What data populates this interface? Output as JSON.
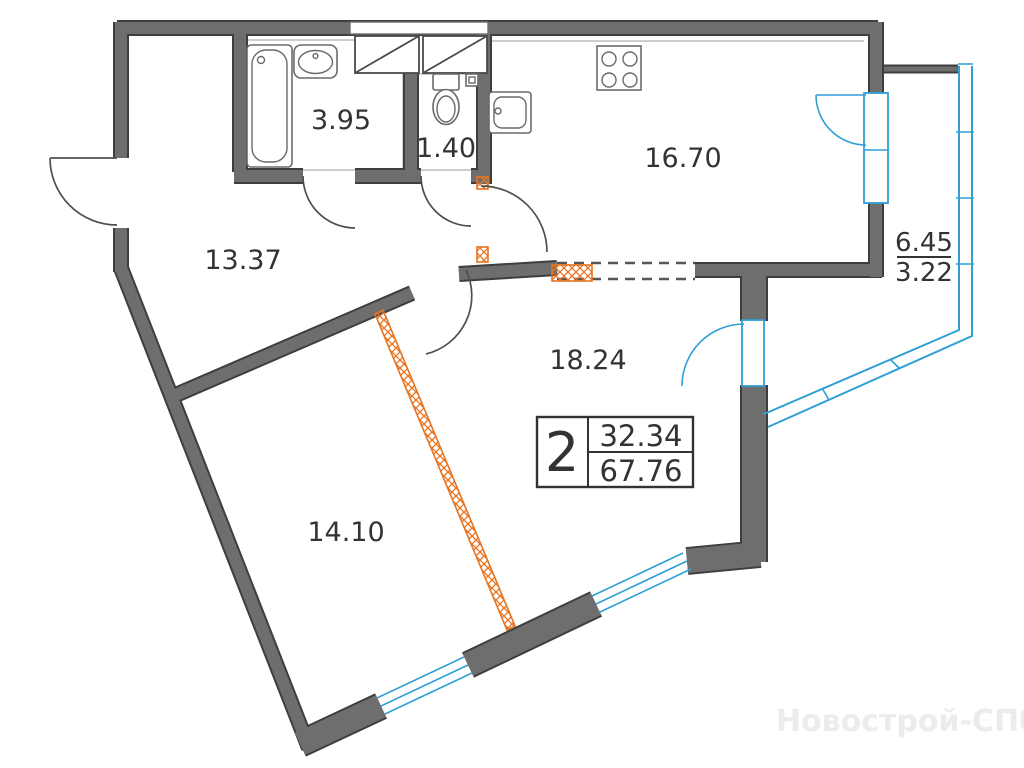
{
  "rooms": {
    "bathroom": {
      "area": "3.95"
    },
    "toilet": {
      "area": "1.40"
    },
    "kitchen": {
      "area": "16.70"
    },
    "hallway": {
      "area": "13.37"
    },
    "living_room": {
      "area": "18.24"
    },
    "bedroom": {
      "area": "14.10"
    }
  },
  "balcony": {
    "area_total": "6.45",
    "area_counted": "3.22"
  },
  "summary_box": {
    "room_count": "2",
    "living_area": "32.34",
    "total_area": "67.76"
  },
  "watermark": {
    "text": "Новострой-СПб"
  },
  "fixtures": [
    "bathtub",
    "washbasin",
    "toilet",
    "ventilation-shaft",
    "kitchen-sink",
    "stove"
  ],
  "colors": {
    "wall_fill": "#6e6e6e",
    "wall_edge": "#3e3e3e",
    "fixture": "#6a6a6a",
    "door": "#4f4f4f",
    "glass": "#2f9fd6",
    "orange": "#e8731f",
    "ink": "#333333",
    "watermark": "#ececec",
    "bg": "#ffffff"
  }
}
